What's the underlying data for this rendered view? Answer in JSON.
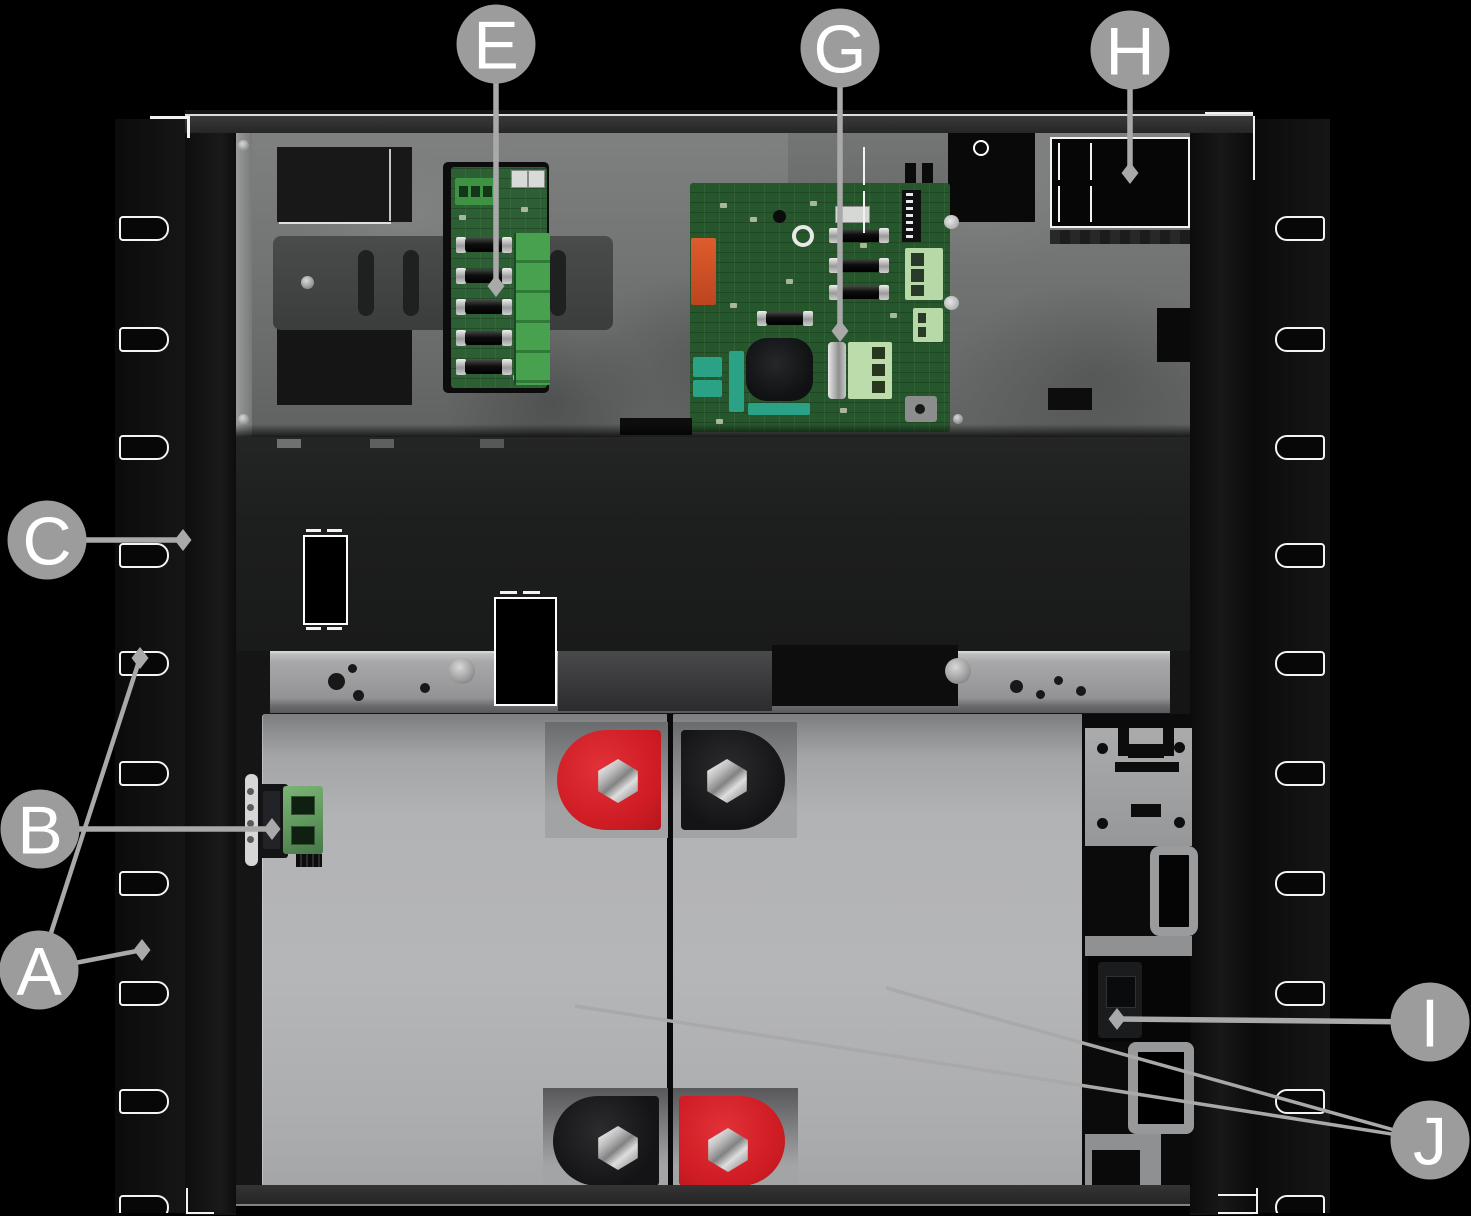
{
  "figure": {
    "kind": "labeled hardware illustration",
    "subject": "rack-mount control panel enclosure interior with circuit boards and backup batteries"
  },
  "callouts": [
    {
      "letter": "A"
    },
    {
      "letter": "B"
    },
    {
      "letter": "C"
    },
    {
      "letter": "E"
    },
    {
      "letter": "G"
    },
    {
      "letter": "H"
    },
    {
      "letter": "I"
    },
    {
      "letter": "J"
    }
  ],
  "colors": {
    "background": "#000000",
    "callout_circle": "#9c9c9c",
    "callout_letter": "#ffffff",
    "leader_line": "#a9a9a9",
    "enclosure_black": "#141414",
    "mounting_plate_gray": "#757776",
    "battery_gray": "#b0b1b3",
    "terminal_positive_red": "#d6202a",
    "terminal_negative_black": "#17171a",
    "pcb_green": "#26572c",
    "terminal_block_green": "#3f9144",
    "terminal_block_light_green": "#b7d9a8",
    "relay_orange": "#cd4e24",
    "component_teal": "#2ba286"
  }
}
